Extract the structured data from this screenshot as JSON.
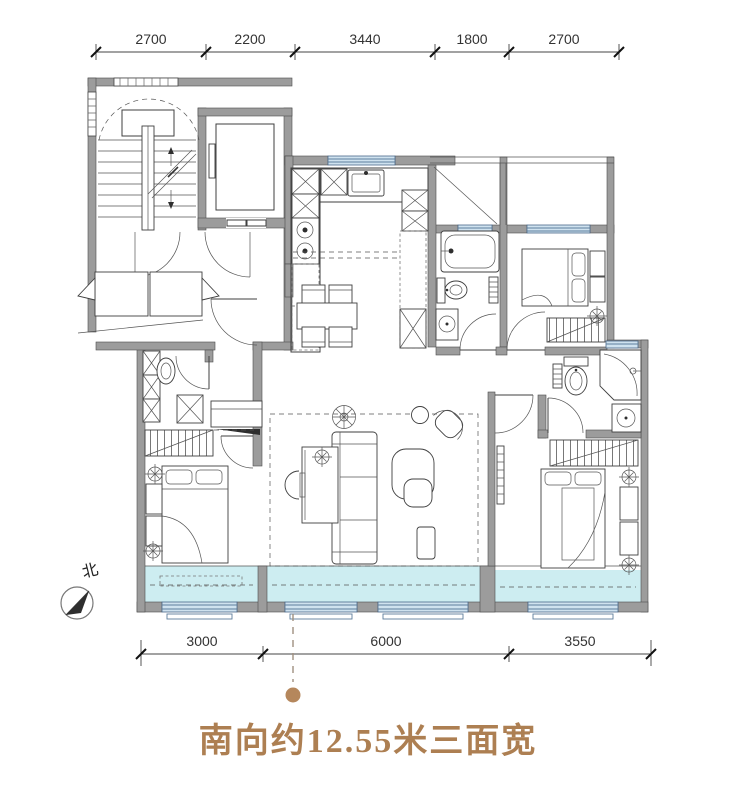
{
  "dimensions": {
    "top": [
      "2700",
      "2200",
      "3440",
      "1800",
      "2700"
    ],
    "bottom": [
      "3000",
      "6000",
      "3550"
    ]
  },
  "north": {
    "label": "北"
  },
  "caption": {
    "text": "南向约12.55米三面宽",
    "color": "#ad7f52"
  },
  "callout": {
    "dot_color": "#b5875c"
  },
  "colors": {
    "wall": "#9c9c9c",
    "balcony_fill": "#cdedf1",
    "window_fill": "#cfe2ef",
    "window_stroke": "#49688a",
    "line": "#3f3f3f"
  }
}
